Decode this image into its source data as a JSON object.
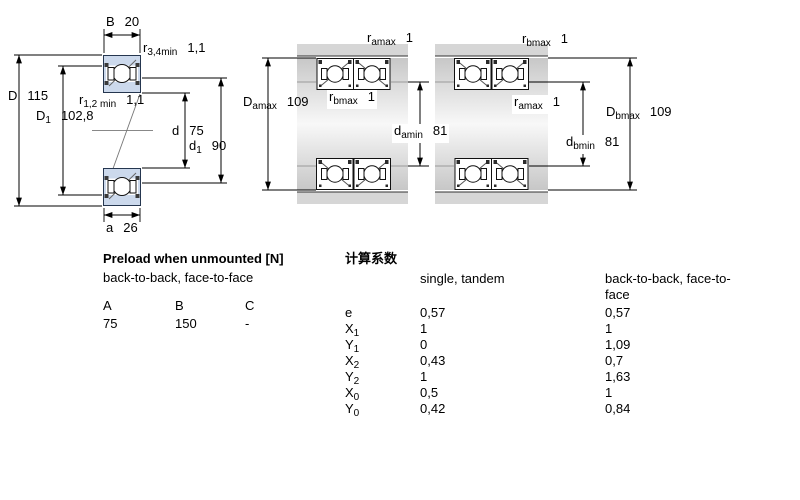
{
  "left_diagram": {
    "labels": {
      "B": {
        "sym": "B",
        "sub": "",
        "val": "20"
      },
      "r34": {
        "sym": "r",
        "sub": "3,4min",
        "val": "1,1"
      },
      "r12": {
        "sym": "r",
        "sub": "1,2 min",
        "val": "1,1"
      },
      "D": {
        "sym": "D",
        "sub": "",
        "val": "115"
      },
      "D1": {
        "sym": "D",
        "sub": "1",
        "val": "102,8"
      },
      "d": {
        "sym": "d",
        "sub": "",
        "val": "75"
      },
      "d1": {
        "sym": "d",
        "sub": "1",
        "val": "90"
      },
      "a": {
        "sym": "a",
        "sub": "",
        "val": "26"
      }
    }
  },
  "middle_diagram": {
    "labels": {
      "ramax": {
        "sym": "r",
        "sub": "amax",
        "val": "1"
      },
      "rbmax": {
        "sym": "r",
        "sub": "bmax",
        "val": "1"
      },
      "Damax": {
        "sym": "D",
        "sub": "amax",
        "val": "109"
      },
      "damin": {
        "sym": "d",
        "sub": "amin",
        "val": "81"
      }
    }
  },
  "right_diagram": {
    "labels": {
      "rbmax": {
        "sym": "r",
        "sub": "bmax",
        "val": "1"
      },
      "ramax": {
        "sym": "r",
        "sub": "amax",
        "val": "1"
      },
      "Dbmax": {
        "sym": "D",
        "sub": "bmax",
        "val": "109"
      },
      "dbmin": {
        "sym": "d",
        "sub": "bmin",
        "val": "81"
      }
    }
  },
  "preload_table": {
    "title": "Preload when unmounted [N]",
    "subtitle": "back-to-back, face-to-face",
    "columns": [
      "A",
      "B",
      "C"
    ],
    "values": [
      "75",
      "150",
      "-"
    ]
  },
  "factors_table": {
    "title": "计算系数",
    "col1_header": "single, tandem",
    "col2_header": "back-to-back, face-to-face",
    "rows": [
      {
        "sym": "e",
        "sub": "",
        "v1": "0,57",
        "v2": "0,57"
      },
      {
        "sym": "X",
        "sub": "1",
        "v1": "1",
        "v2": "1"
      },
      {
        "sym": "Y",
        "sub": "1",
        "v1": "0",
        "v2": "1,09"
      },
      {
        "sym": "X",
        "sub": "2",
        "v1": "0,43",
        "v2": "0,7"
      },
      {
        "sym": "Y",
        "sub": "2",
        "v1": "1",
        "v2": "1,63"
      },
      {
        "sym": "X",
        "sub": "0",
        "v1": "0,5",
        "v2": "1"
      },
      {
        "sym": "Y",
        "sub": "0",
        "v1": "0,42",
        "v2": "0,84"
      }
    ]
  },
  "colors": {
    "bearing_fill": "#ccd9ec",
    "housing_grey": "#d6d6d6",
    "line": "#000000"
  }
}
